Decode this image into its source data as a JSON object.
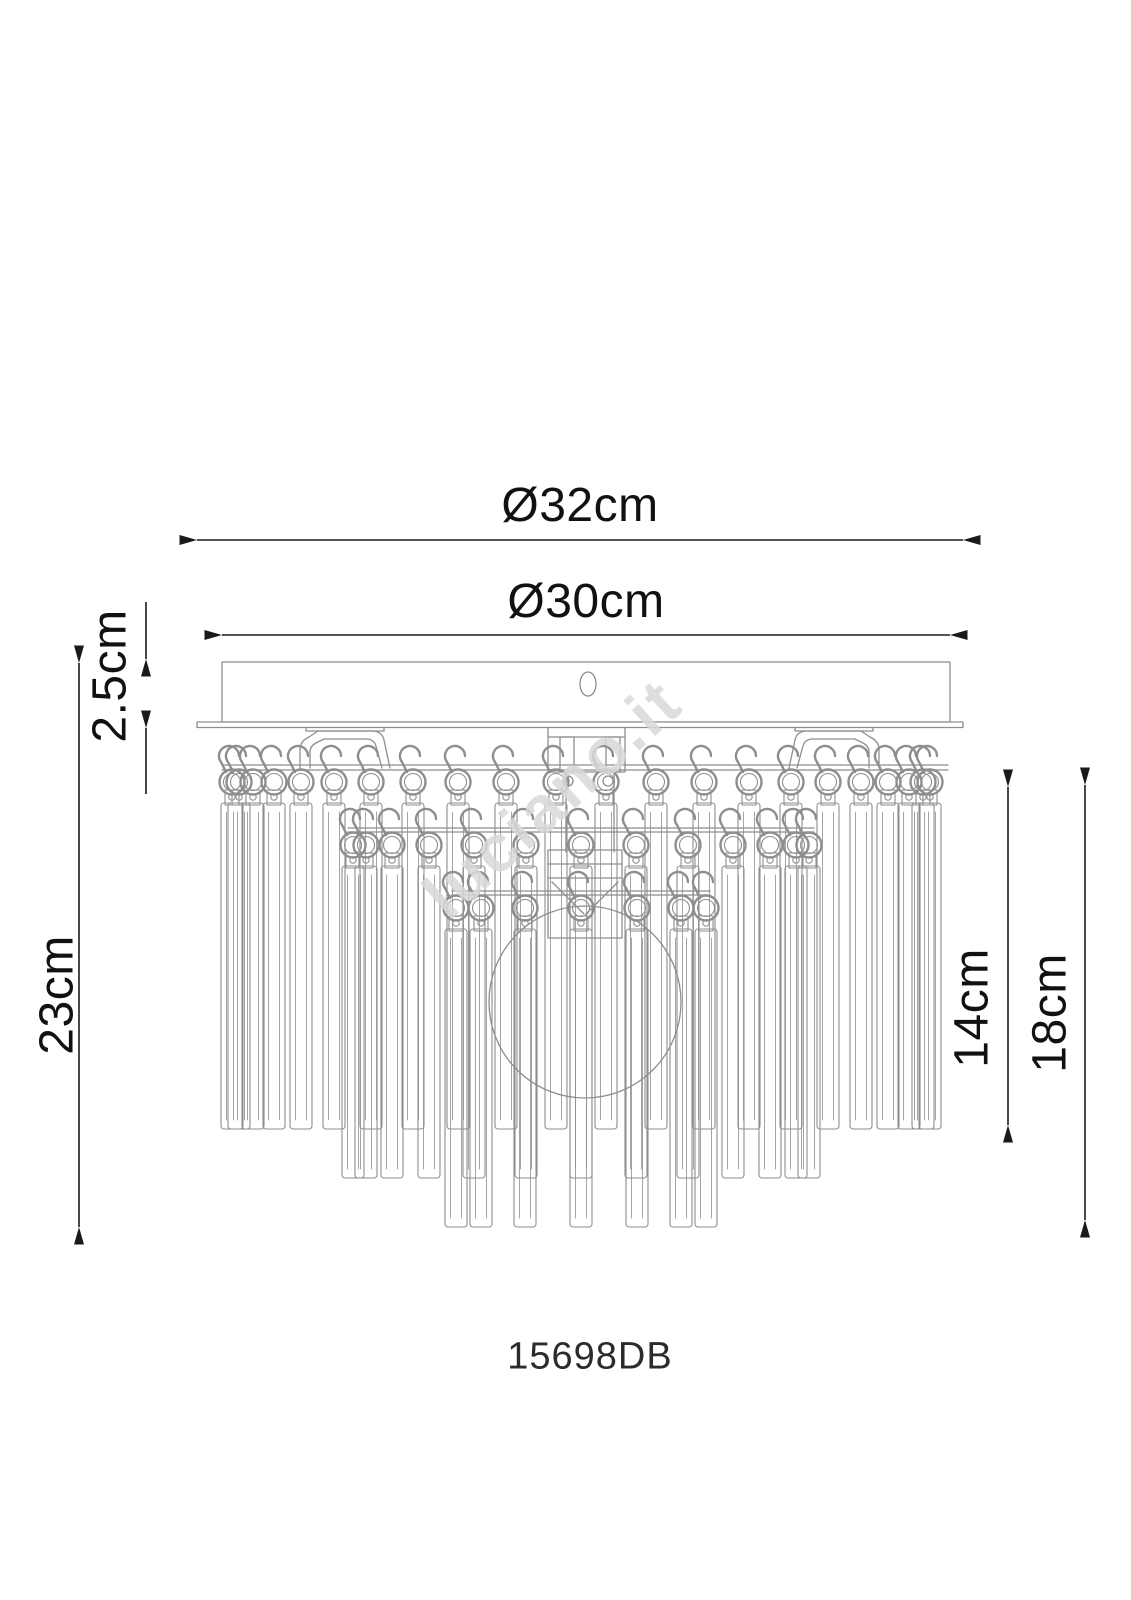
{
  "diagram": {
    "model_number": "15698DB",
    "watermark_text": "luciano.it",
    "colors": {
      "background": "#ffffff",
      "artwork_line": "#8e8e8e",
      "dimension_line": "#1a1a1a",
      "watermark": "#d9d9d9"
    },
    "dimensions": {
      "outer_diameter": {
        "label": "Ø32cm",
        "orientation": "horizontal"
      },
      "canopy_diameter": {
        "label": "Ø30cm",
        "orientation": "horizontal"
      },
      "canopy_height": {
        "label": "2.5cm",
        "orientation": "vertical"
      },
      "total_height": {
        "label": "23cm",
        "orientation": "vertical"
      },
      "first_tier_drop": {
        "label": "14cm",
        "orientation": "vertical"
      },
      "crystal_drop": {
        "label": "18cm",
        "orientation": "vertical"
      }
    }
  }
}
